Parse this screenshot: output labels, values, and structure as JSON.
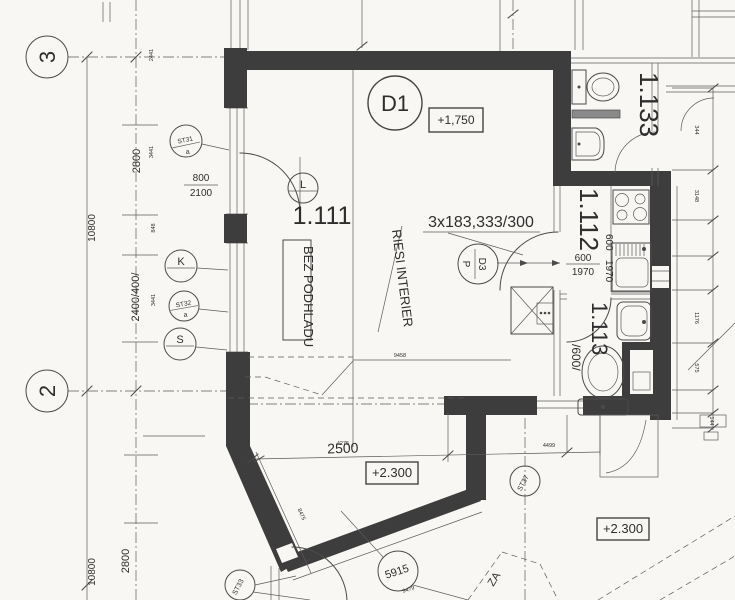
{
  "grid": {
    "axis_top": "3",
    "axis_bottom": "2"
  },
  "left_dims": {
    "overall_a": "10800",
    "overall_b": "10800",
    "span_a": "2800",
    "span_mid": "2400/400/",
    "span_b": "2800",
    "tick_a": "2441",
    "tick_b": "3441",
    "tick_c": "848",
    "tick_d": "3441"
  },
  "door_main": {
    "width": "800",
    "height": "2100",
    "swing": "L"
  },
  "markers": {
    "st31": "ST31",
    "st31_sub": "a",
    "k": "K",
    "st32": "ST32",
    "st32_sub": "a",
    "s": "S",
    "st33": "ST33",
    "st37": "ST37",
    "arc_radius": "5915",
    "arc_radius_sub": "9479",
    "zone": "ZA"
  },
  "rooms": {
    "living": "1.111",
    "kitchen": "1.112",
    "bath_upper": "1.133",
    "bath_lower": "1.113"
  },
  "notes": {
    "door_d1": "D1",
    "level_main": "+1,750",
    "stair": "3x183,333/300",
    "interior": "RIESI INTERIER",
    "no_soffit": "BEZ PODHLADU",
    "door_d3": "D3",
    "door_d3_side": "P"
  },
  "kitchen_door": {
    "width": "600",
    "height": "1970",
    "width_rot": "600",
    "height_rot": "1970"
  },
  "bath_lower_dim": "/600/",
  "bay": {
    "width": "2500",
    "width_top": "4275",
    "level": "+2.300",
    "level_right": "+2.300",
    "dim_diag": "8475",
    "dim_span": "9458",
    "dim_right": "4499"
  },
  "right_dims": {
    "a": "344",
    "b": "3148",
    "c": "1176",
    "d": "575",
    "e": "144"
  }
}
